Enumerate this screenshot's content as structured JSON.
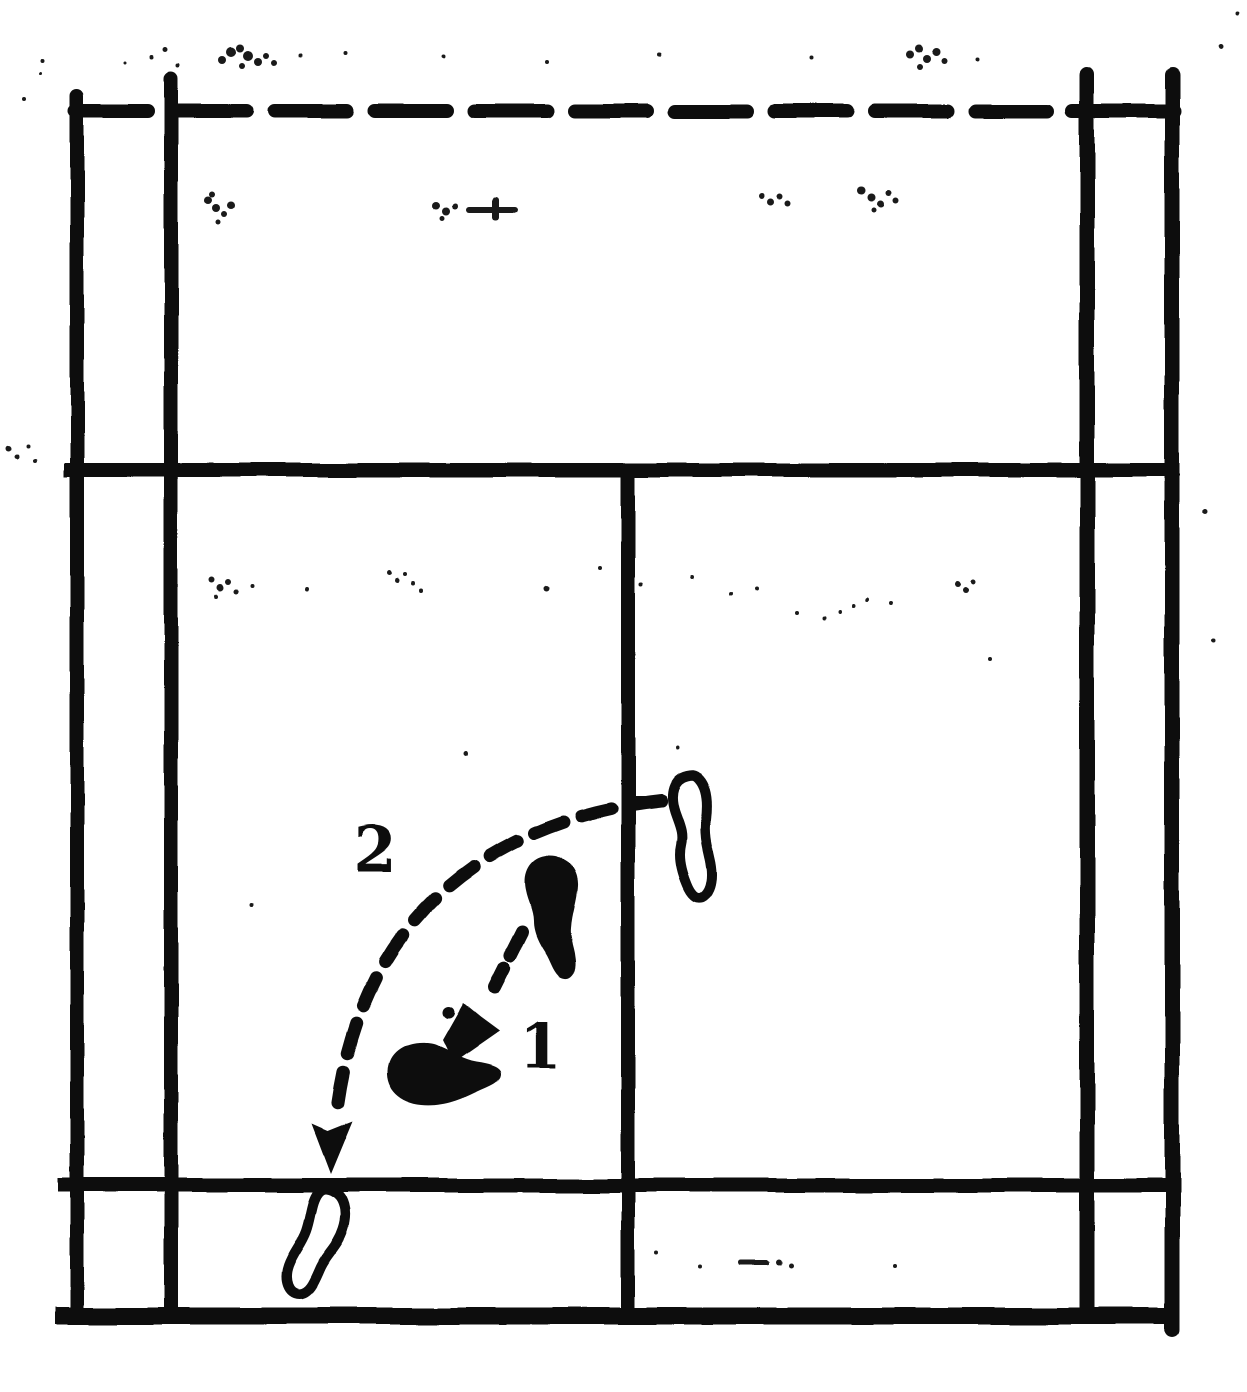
{
  "colors": {
    "paper": "#ffffff",
    "ink": "#0b0b0b"
  },
  "diagram": {
    "kind": "scanned badminton half-court footwork diagram",
    "labels": {
      "step_1": "1",
      "step_2": "2"
    },
    "court_lines": [
      "net-line-dashed",
      "left-doubles-sideline",
      "left-singles-sideline",
      "right-singles-sideline",
      "right-doubles-sideline",
      "short-service-line",
      "centre-line",
      "doubles-long-service-line",
      "back-boundary-line"
    ],
    "movement": {
      "route_1": "short dashed arrow from filled footprint down-left to landing footprint",
      "route_2": "long dashed arc from outlined footprint at centre line down to back court"
    }
  }
}
